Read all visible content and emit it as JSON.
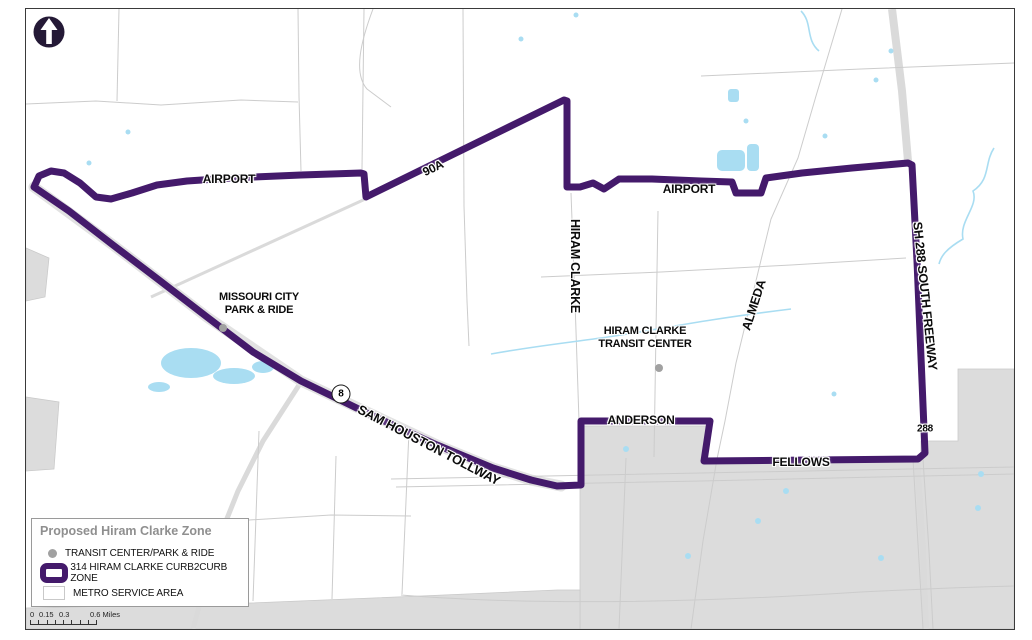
{
  "colors": {
    "zone": "#441a6b",
    "water": "#a9ddf2",
    "service_gray": "#dcdcdc",
    "road": "#cccccc",
    "dot": "#a1a1a1"
  },
  "labels": {
    "airport_west": "AIRPORT",
    "hwy_90a": "90A",
    "airport_east": "AIRPORT",
    "hiram_clarke_rd": "HIRAM CLARKE",
    "almeda_rd": "ALMEDA",
    "sh288": "SH 288 SOUTH FREEWAY",
    "sh288_ref": "288",
    "beltway8": "8",
    "sam_houston": "SAM HOUSTON TOLLWAY",
    "anderson": "ANDERSON",
    "fellows": "FELLOWS",
    "missouri_city_1": "MISSOURI CITY",
    "missouri_city_2": "PARK & RIDE",
    "transit_center_1": "HIRAM CLARKE",
    "transit_center_2": "TRANSIT CENTER"
  },
  "legend": {
    "title": "Proposed Hiram Clarke Zone",
    "items": [
      {
        "label": "TRANSIT CENTER/PARK & RIDE"
      },
      {
        "label": "314 HIRAM CLARKE CURB2CURB ZONE"
      },
      {
        "label": "METRO SERVICE AREA"
      }
    ]
  },
  "scalebar": {
    "t0": "0",
    "t1": "0.15",
    "t2": "0.3",
    "t3": "0.6 Miles"
  }
}
